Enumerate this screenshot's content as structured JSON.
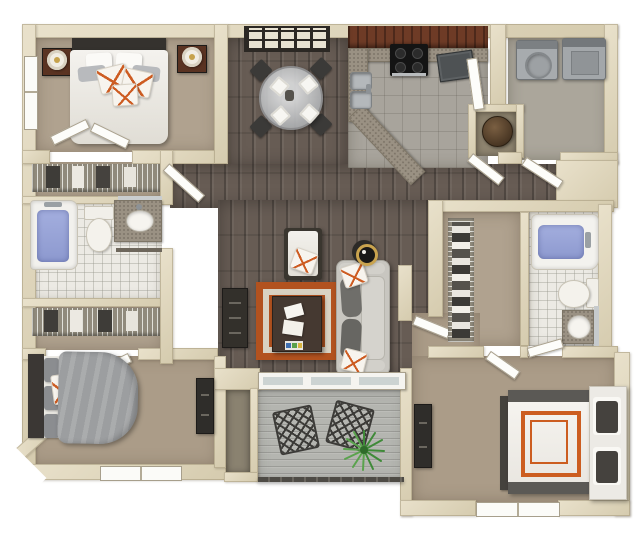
{
  "scene": {
    "render_style": "top-down 3D architectural floor plan rendering, no text labels",
    "rooms": [
      {
        "id": "bedroom-1",
        "label": "Bedroom 1 (top left)",
        "floor": "tan carpet",
        "furniture": [
          "queen bed, white duvet",
          "dark charcoal headboard",
          "white and gray pillows",
          "three white pillows with orange trim",
          "two dark wood nightstands",
          "two round white lamps",
          "window on left wall",
          "double closet doors"
        ]
      },
      {
        "id": "closet-1",
        "label": "Bedroom 1 closet",
        "floor": "tan carpet",
        "furniture": [
          "wire shelf with hanging clothes"
        ]
      },
      {
        "id": "bathroom-1",
        "label": "Bathroom 1 (left)",
        "floor": "white tile",
        "furniture": [
          "bathtub with blue water",
          "toilet",
          "granite vanity with oval sink",
          "mirror",
          "towel bar"
        ]
      },
      {
        "id": "closet-2",
        "label": "Bedroom 2 closet",
        "floor": "tan carpet",
        "furniture": [
          "wire shelf with hanging clothes"
        ]
      },
      {
        "id": "bedroom-2",
        "label": "Bedroom 2 (bottom left)",
        "floor": "tan carpet",
        "furniture": [
          "bed with gray duvet",
          "dark charcoal headboard",
          "three gray pillows",
          "orange patterned accent pillow",
          "dark dresser",
          "window on bottom wall"
        ]
      },
      {
        "id": "dining",
        "label": "Dining area",
        "floor": "dark hardwood",
        "furniture": [
          "round glass dining table",
          "four dark chairs",
          "four white place settings",
          "dark wall shelf unit"
        ]
      },
      {
        "id": "kitchen",
        "label": "Kitchen",
        "floor": "gray tile",
        "furniture": [
          "dark red-brown cabinets",
          "granite countertop with angled peninsula",
          "black range with four burners",
          "double stainless sink",
          "dark gray dishwasher",
          "white door"
        ]
      },
      {
        "id": "laundry",
        "label": "Laundry room",
        "floor": "gray tile",
        "furniture": [
          "washer with round lid",
          "dryer"
        ]
      },
      {
        "id": "utility-niche",
        "label": "Utility niche",
        "floor": "dark tan",
        "furniture": [
          "round brown water heater"
        ]
      },
      {
        "id": "hallway",
        "label": "Hallway",
        "floor": "dark hardwood",
        "furniture": [
          "open white doors"
        ]
      },
      {
        "id": "living",
        "label": "Living room",
        "floor": "dark hardwood",
        "furniture": [
          "light gray sofa with dark cushions and orange pillows",
          "white chaise chair with orange pillow",
          "orange and cream greek-key rug",
          "dark coffee table with books and tray",
          "dark media console",
          "round side table with lamp"
        ]
      },
      {
        "id": "walk-in-closet",
        "label": "Walk-in closet",
        "floor": "tan carpet",
        "furniture": [
          "long wire shelf with folded clothes"
        ]
      },
      {
        "id": "bathroom-2",
        "label": "Bathroom 2 (master)",
        "floor": "white tile",
        "furniture": [
          "bathtub with blue water",
          "toilet",
          "granite vanity with round sink",
          "mirror"
        ]
      },
      {
        "id": "bedroom-3",
        "label": "Bedroom 3 (bottom right, master)",
        "floor": "tan carpet",
        "furniture": [
          "bed with white duvet and double orange border",
          "dark gray blanket bands",
          "white headboard bench with dark pillows",
          "dark dresser",
          "window on bottom wall"
        ]
      },
      {
        "id": "patio",
        "label": "Patio",
        "floor": "gray wood decking",
        "furniture": [
          "sliding glass door",
          "two dark metal mesh chairs",
          "green spiky plant",
          "railing"
        ]
      },
      {
        "id": "patio-storage",
        "label": "Patio storage closet",
        "floor": "olive gray",
        "furniture": []
      }
    ],
    "palette": {
      "background": "#ffffff",
      "wall": "#ddd3ba",
      "wall_shadow": "#c2b79a",
      "carpet": "#b0a28f",
      "carpet_dark": "#ab9c88",
      "hardwood": "#675c54",
      "tile_white": "#eceae4",
      "tile_gray": "#a8a49c",
      "deck_gray": "#b4b5b0",
      "water_blue": "#97a3d8",
      "granite": "#9a9183",
      "cabinet_wood": "#6e3b26",
      "accent_orange": "#cd5c22",
      "rug_orange": "#b2521f",
      "rug_cream": "#d9d2c2",
      "sofa_gray": "#c8c6c0",
      "charcoal": "#3a3734",
      "appliance_gray": "#a7abae",
      "plant_green": "#3f8a38",
      "storage_olive": "#8a8270"
    }
  }
}
